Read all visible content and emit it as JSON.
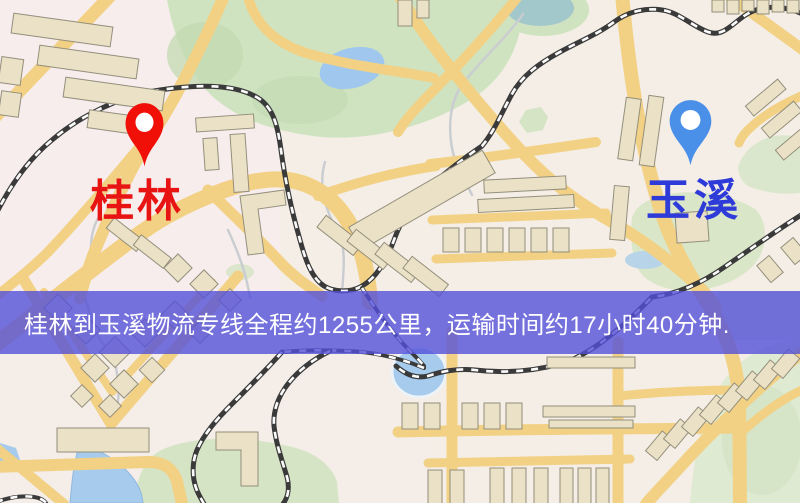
{
  "route": {
    "origin": {
      "name": "桂林",
      "pin_icon": "map-pin",
      "pin_color": "#f01008",
      "label_color": "#e81414"
    },
    "destination": {
      "name": "玉溪",
      "pin_icon": "map-pin",
      "pin_color": "#4a90e8",
      "label_color": "#2e3bd8"
    }
  },
  "banner": {
    "text": "桂林到玉溪物流专线全程约1255公里，运输时间约17小时40分钟.",
    "background_color": "#5450da",
    "text_color": "#ffffff"
  },
  "map_colors": {
    "background": "#f4eee6",
    "road": "#f2d184",
    "park": "#cfe3c0",
    "water": "#a6cbec",
    "building": "#eae1c6",
    "railway": "#3a3a3a"
  }
}
